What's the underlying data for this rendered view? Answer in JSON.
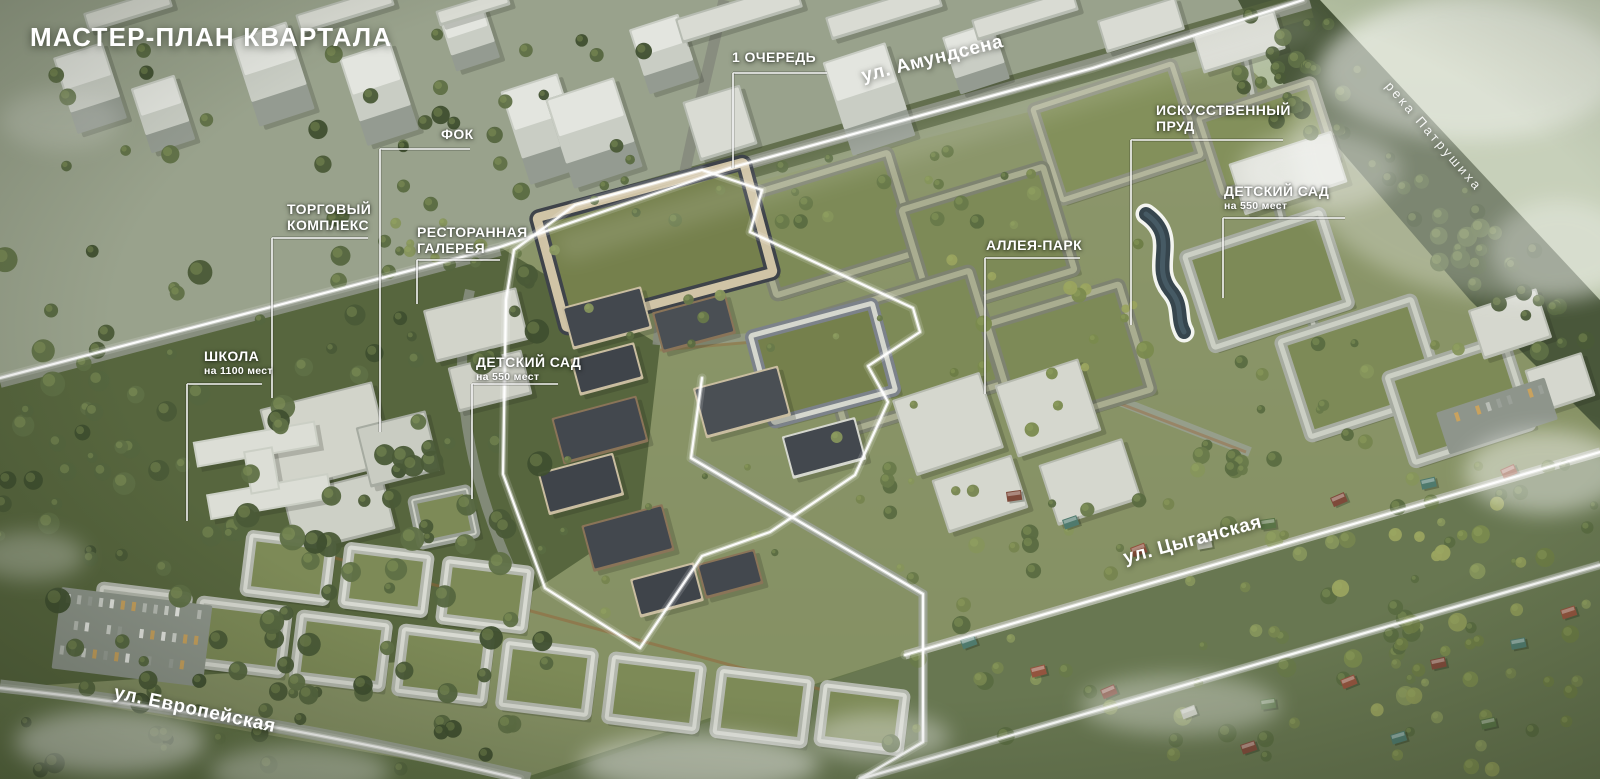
{
  "title": "МАСТЕР-ПЛАН КВАРТАЛА",
  "labels": {
    "phase1": {
      "text": "1 ОЧЕРЕДЬ"
    },
    "fok": {
      "text": "ФОК"
    },
    "shopping": {
      "line1": "ТОРГОВЫЙ",
      "line2": "КОМПЛЕКС"
    },
    "restaurant": {
      "line1": "РЕСТОРАННАЯ",
      "line2": "ГАЛЕРЕЯ"
    },
    "pond": {
      "line1": "ИСКУССТВЕННЫЙ",
      "line2": "ПРУД"
    },
    "kindergarten_right": {
      "text": "ДЕТСКИЙ САД",
      "sub": "на 550 мест"
    },
    "alley_park": {
      "text": "АЛЛЕЯ-ПАРК"
    },
    "school": {
      "text": "ШКОЛА",
      "sub": "на 1100 мест"
    },
    "kindergarten_center": {
      "text": "ДЕТСКИЙ САД",
      "sub": "на 550 мест"
    }
  },
  "streets": {
    "amundsena": "ул. Амундсена",
    "tsyganskaya": "ул. Цыганская",
    "evropeyskaya": "ул. Европейская"
  },
  "river": "река Патрушиха",
  "colors": {
    "outline": "#ffffff",
    "label": "#ffffff",
    "pond_water": "#36454d"
  }
}
